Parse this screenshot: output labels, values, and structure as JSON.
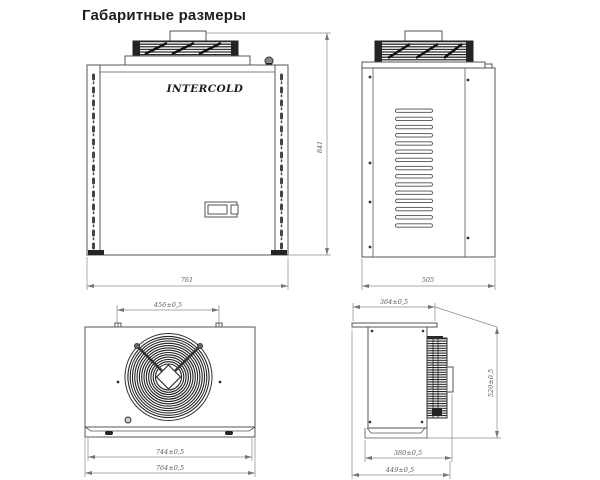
{
  "title": "Габаритные размеры",
  "brand": "INTERCOLD",
  "views": {
    "front": {
      "label": "front-view",
      "width": "761",
      "height": "841"
    },
    "side": {
      "label": "side-view",
      "depth": "505"
    },
    "top": {
      "label": "top-view",
      "fan_pitch": "456±0,5",
      "base_width": "744±0,5",
      "overall_width": "764±0,5"
    },
    "rear": {
      "label": "rear-side-view",
      "flange_depth": "364±0,5",
      "base_depth": "380±0,5",
      "overall_depth": "449±0,5",
      "height": "520±0,5"
    }
  },
  "colors": {
    "background": "#ffffff",
    "line": "#555555",
    "dimension_line": "#8a8a8a",
    "dimension_text": "#5a5a5a",
    "dark_fill": "#242424",
    "title_text": "#1d1d1d"
  }
}
